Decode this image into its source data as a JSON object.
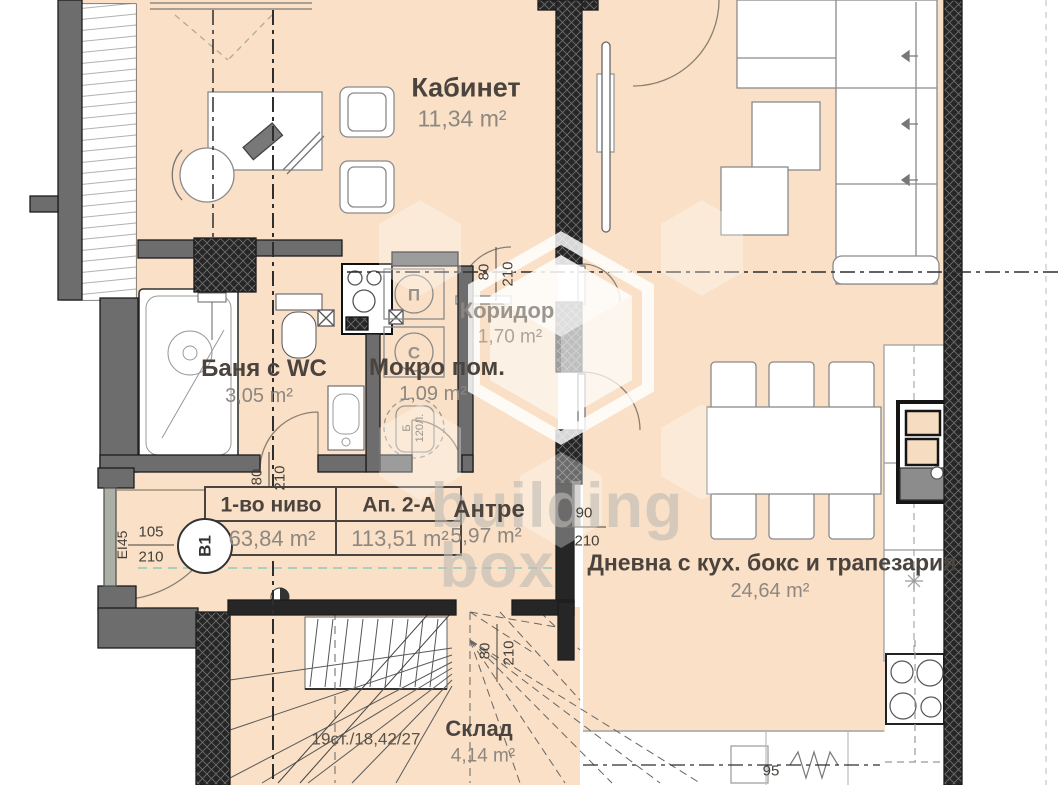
{
  "watermark": {
    "brand_top": "building",
    "brand_bottom": "box"
  },
  "rooms": {
    "kabinet": {
      "name": "Кабинет",
      "area": "11,34 m²"
    },
    "koridor": {
      "name": "Коридор",
      "area": "1,70 m²"
    },
    "banya": {
      "name": "Баня с WC",
      "area": "3,05 m²"
    },
    "mokro": {
      "name": "Мокро пом.",
      "area": "1,09 m²"
    },
    "antre": {
      "name": "Антре",
      "area": "5,97 m²"
    },
    "dnevna": {
      "name": "Дневна с кух. бокс и трапезария",
      "area": "24,64 m²"
    },
    "sklad": {
      "name": "Склад",
      "area": "4,14 m²"
    }
  },
  "info_table": {
    "level_header": "1-во ниво",
    "apartment_header": "Ап. 2-А",
    "level_area": "63,84 m²",
    "apartment_area": "113,51 m²"
  },
  "stairs": {
    "note": "19ст./18,42/27"
  },
  "entrance": {
    "fire_rating": "EI45",
    "door_tag": "В1"
  },
  "dimensions": {
    "entrance_door": {
      "w": "105",
      "h": "210"
    },
    "banya_door": {
      "w": "80",
      "h": "210"
    },
    "koridor_door": {
      "w": "80",
      "h": "210"
    },
    "living_door": {
      "w": "90",
      "h": "210"
    },
    "sklad_door": {
      "w": "80",
      "h": "210"
    },
    "kitchen_width": "95"
  },
  "appliances": {
    "washer_label": "П",
    "dryer_label": "С",
    "boiler_label": "Б",
    "boiler_capacity": "120Л."
  },
  "colors": {
    "floor": "#f9e0c6",
    "wall_gray": "#6d6d6d",
    "wall_dark": "#262626",
    "room_label": "#4b443e",
    "area_label": "#8d8780"
  }
}
